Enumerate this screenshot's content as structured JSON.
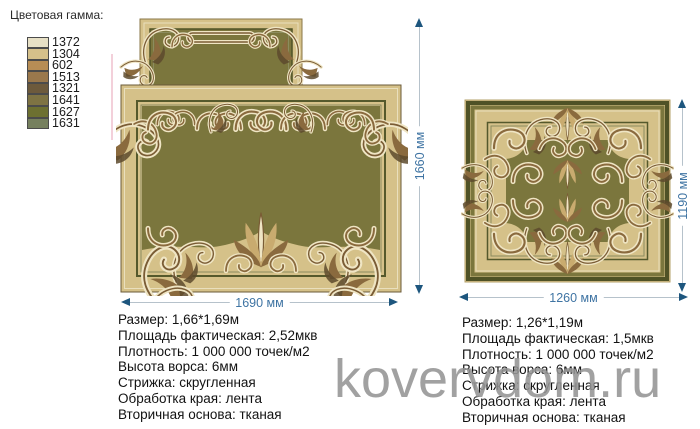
{
  "palette": {
    "title": "Цветовая гамма:",
    "colors": [
      {
        "code": "1372",
        "hex": "#e7e0c5"
      },
      {
        "code": "1304",
        "hex": "#d5c08a"
      },
      {
        "code": "602",
        "hex": "#b78d55"
      },
      {
        "code": "1513",
        "hex": "#9a784c"
      },
      {
        "code": "1321",
        "hex": "#6d5a3c"
      },
      {
        "code": "1641",
        "hex": "#7e7343"
      },
      {
        "code": "1627",
        "hex": "#6d7031"
      },
      {
        "code": "1631",
        "hex": "#76805e"
      }
    ]
  },
  "rugs": [
    {
      "name": "rug-left",
      "width_label": "1690 мм",
      "height_label": "1660 мм",
      "specs": [
        "Размер: 1,66*1,69м",
        "Площадь фактическая: 2,52мкв",
        "Плотность: 1 000 000 точек/м2",
        "Высота ворса: 6мм",
        "Стрижка: скругленная",
        "Обработка края: лента",
        "Вторичная основа: тканая"
      ]
    },
    {
      "name": "rug-right",
      "width_label": "1260 мм",
      "height_label": "1190 мм",
      "specs": [
        "Размер: 1,26*1,19м",
        "Площадь фактическая: 1,5мкв",
        "Плотность: 1 000 000 точек/м2",
        "Высота ворса: 6мм",
        "Стрижка: скругленная",
        "Обработка края: лента",
        "Вторичная основа: тканая"
      ]
    }
  ],
  "watermark": {
    "text": "kovervdom.ru"
  },
  "theme": {
    "dimension_text": "#3f74a3",
    "dimension_arrow": "#1d567e",
    "rug_beige": "#d5c189",
    "rug_green": "#7b763d",
    "rug_dark_olive": "#4f5226",
    "ornament_brown": "#8a6a3e",
    "ornament_cream": "#efe5c4"
  }
}
